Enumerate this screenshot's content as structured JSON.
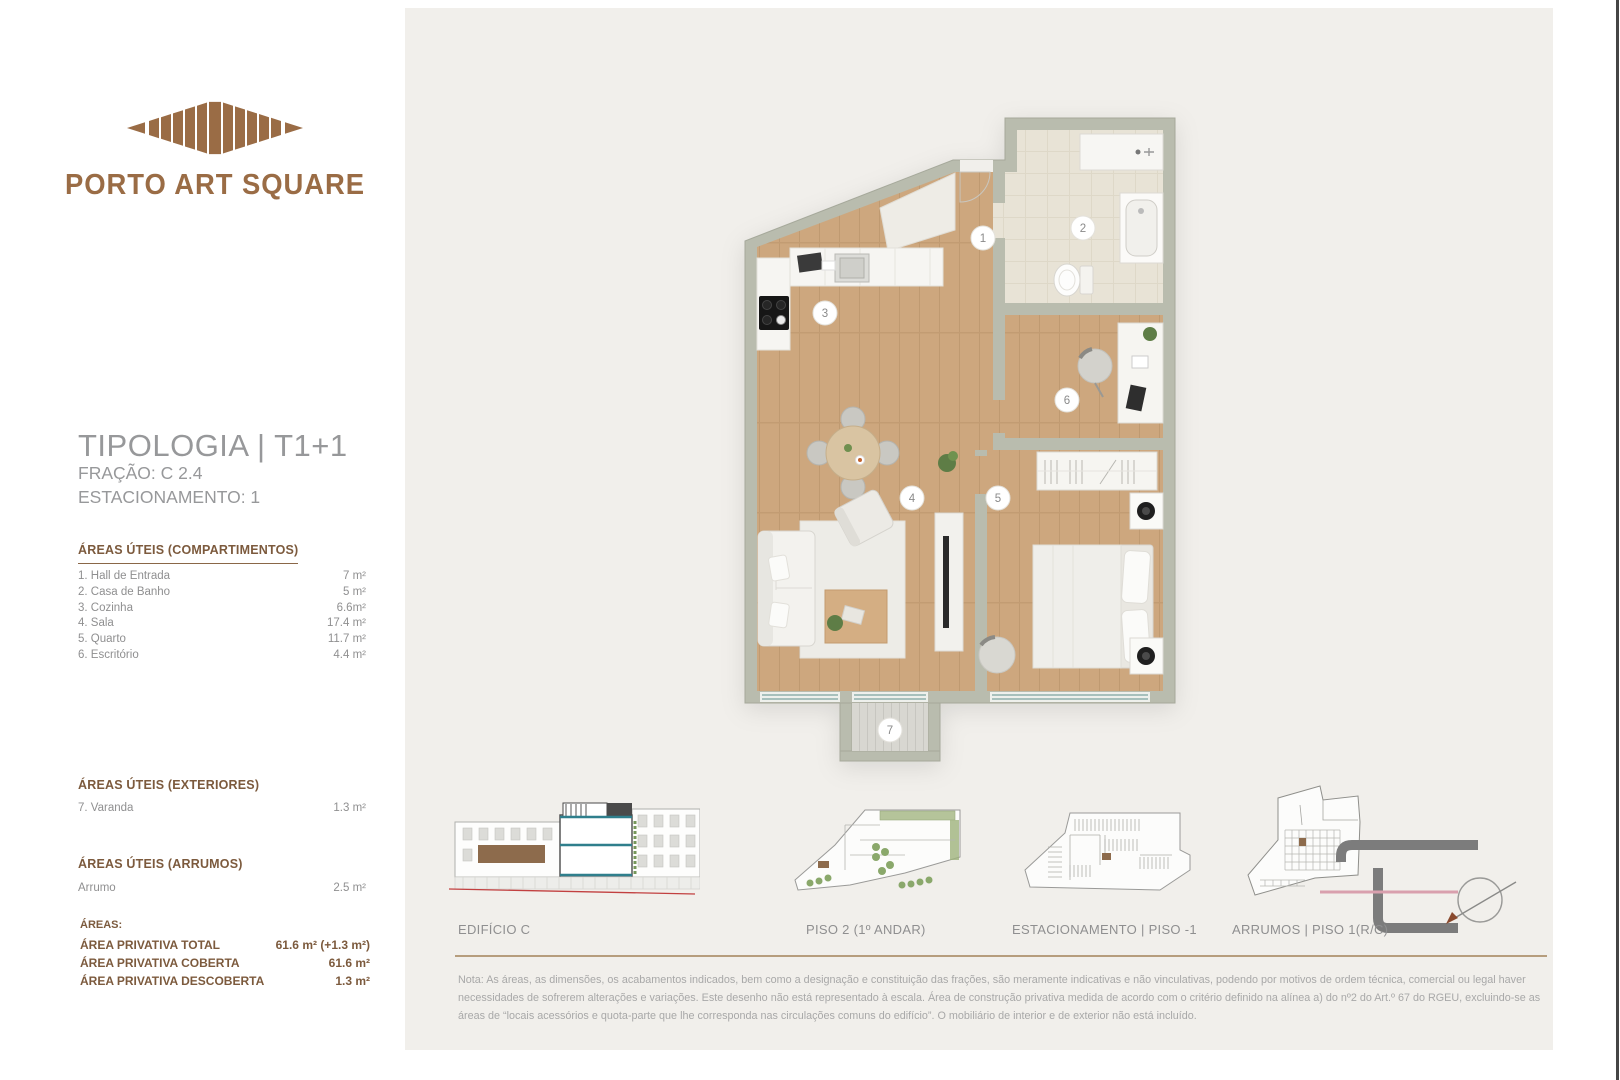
{
  "brand": {
    "name": "PORTO ART SQUARE"
  },
  "title": {
    "typology": "TIPOLOGIA | T1+1",
    "fraction": "FRAÇÃO: C 2.4",
    "parking": "ESTACIONAMENTO: 1"
  },
  "sections": {
    "compartimentos": {
      "heading": "ÁREAS ÚTEIS (COMPARTIMENTOS)",
      "items": [
        {
          "label": "1. Hall de Entrada",
          "value": "7 m²"
        },
        {
          "label": "2. Casa de Banho",
          "value": "5 m²"
        },
        {
          "label": "3. Cozinha",
          "value": "6.6m²"
        },
        {
          "label": "4. Sala",
          "value": "17.4 m²"
        },
        {
          "label": "5. Quarto",
          "value": "11.7 m²"
        },
        {
          "label": "6. Escritório",
          "value": "4.4 m²"
        }
      ]
    },
    "exteriores": {
      "heading": "ÁREAS ÚTEIS (EXTERIORES)",
      "items": [
        {
          "label": "7. Varanda",
          "value": "1.3 m²"
        }
      ]
    },
    "arrumos": {
      "heading": "ÁREAS ÚTEIS (ARRUMOS)",
      "items": [
        {
          "label": "Arrumo",
          "value": "2.5 m²"
        }
      ]
    },
    "totals": {
      "heading": "ÁREAS:",
      "items": [
        {
          "label": "ÁREA PRIVATIVA TOTAL",
          "value": "61.6 m² (+1.3 m²)"
        },
        {
          "label": "ÁREA PRIVATIVA COBERTA",
          "value": "61.6 m²"
        },
        {
          "label": "ÁREA PRIVATIVA DESCOBERTA",
          "value": "1.3 m²"
        }
      ]
    }
  },
  "plan": {
    "badges": [
      {
        "number": "1"
      },
      {
        "number": "2"
      },
      {
        "number": "3"
      },
      {
        "number": "4"
      },
      {
        "number": "5"
      },
      {
        "number": "6"
      },
      {
        "number": "7"
      }
    ]
  },
  "diagrams": {
    "captions": [
      "EDIFÍCIO C",
      "PISO 2 (1º ANDAR)",
      "ESTACIONAMENTO  |  PISO -1",
      "ARRUMOS  |  PISO 1(R/C)"
    ]
  },
  "note": {
    "text": "Nota: As áreas, as dimensões, os acabamentos indicados, bem como a designação e constituição das frações, são meramente indicativas e não vinculativas, podendo por motivos de ordem técnica, comercial ou legal haver necessidades de sofrerem alterações e variações. Este desenho não está representado à escala. Área de construção privativa medida de acordo com o critério definido na alínea a) do nº2 do Art.º 67 do RGEU, excluindo-se as áreas de “locais acessórios e quota-parte que lhe corresponda nas circulações comuns do edifício”. O mobiliário de interior e de exterior não está incluído."
  },
  "colors": {
    "brand_brown": "#9a6c45",
    "heading_brown": "#7c5a3d",
    "divider_brown": "#b69d7d",
    "text_gray": "#8f8f90",
    "wall_gray_green": "#b9bcae",
    "wood_floor": "#cda77e",
    "tile_floor": "#e8e3d6",
    "ground_line_red": "#c24040",
    "section_teal": "#2f7f8c"
  }
}
